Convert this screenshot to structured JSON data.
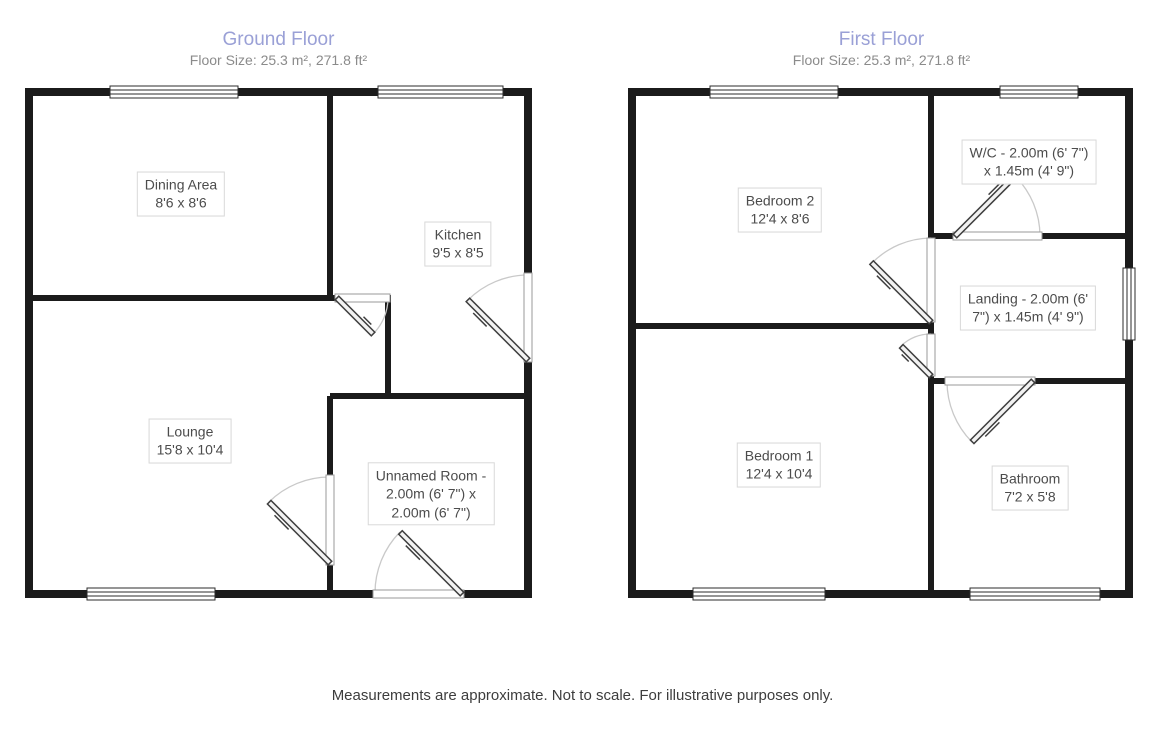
{
  "colors": {
    "floor_title": "#9aa0d6",
    "floor_subtitle": "#8b8b8b",
    "wall": "#1b1b1b",
    "label_border": "#d8d8d8",
    "label_text": "#4c4c4c",
    "door_arc": "#c9c9c9"
  },
  "floors": [
    {
      "title": "Ground Floor",
      "subtitle": "Floor Size: 25.3 m², 271.8 ft²",
      "rooms": [
        {
          "name": "Dining Area",
          "size": "8'6 x 8'6",
          "lines": [
            "Dining Area",
            "8'6 x 8'6"
          ]
        },
        {
          "name": "Kitchen",
          "size": "9'5 x 8'5",
          "lines": [
            "Kitchen",
            "9'5 x 8'5"
          ]
        },
        {
          "name": "Lounge",
          "size": "15'8 x 10'4",
          "lines": [
            "Lounge",
            "15'8 x 10'4"
          ]
        },
        {
          "name": "Unnamed Room",
          "size": "2.00m (6' 7\") x 2.00m (6' 7\")",
          "lines": [
            "Unnamed Room -",
            "2.00m (6' 7\") x",
            "2.00m (6' 7\")"
          ]
        }
      ]
    },
    {
      "title": "First Floor",
      "subtitle": "Floor Size: 25.3 m², 271.8 ft²",
      "rooms": [
        {
          "name": "Bedroom 2",
          "size": "12'4 x 8'6",
          "lines": [
            "Bedroom 2",
            "12'4 x 8'6"
          ]
        },
        {
          "name": "W/C",
          "size": "2.00m (6' 7\") x 1.45m (4' 9\")",
          "lines": [
            "W/C - 2.00m (6' 7\")",
            "x 1.45m (4' 9\")"
          ]
        },
        {
          "name": "Landing",
          "size": "2.00m (6' 7\") x 1.45m (4' 9\")",
          "lines": [
            "Landing - 2.00m (6'",
            "7\") x 1.45m (4' 9\")"
          ]
        },
        {
          "name": "Bedroom 1",
          "size": "12'4 x 10'4",
          "lines": [
            "Bedroom 1",
            "12'4 x 10'4"
          ]
        },
        {
          "name": "Bathroom",
          "size": "7'2 x 5'8",
          "lines": [
            "Bathroom",
            "7'2 x 5'8"
          ]
        }
      ]
    }
  ],
  "footer": {
    "disclaimer": "Measurements are approximate. Not to scale. For illustrative purposes only."
  }
}
